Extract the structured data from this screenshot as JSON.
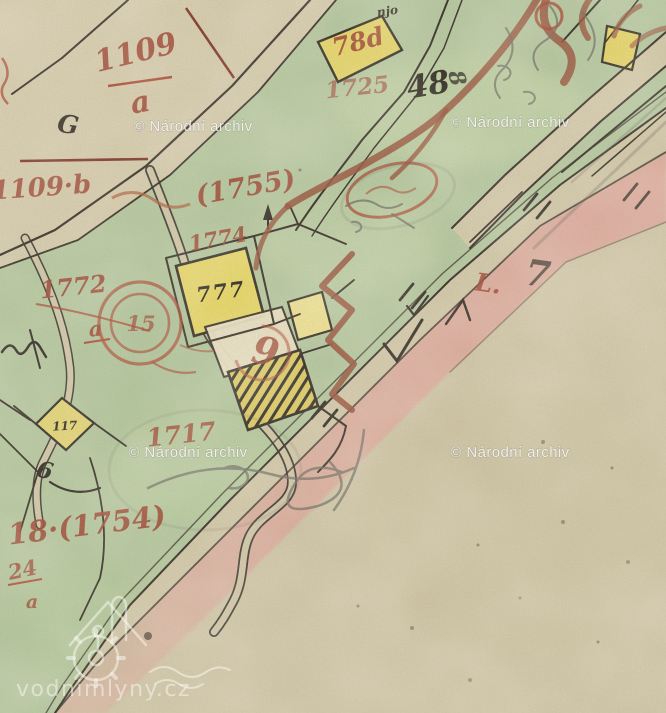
{
  "watermarks": {
    "archive": "© Národní archiv",
    "site": "vodnimlyny.cz"
  },
  "labels_red": {
    "frac1109_num": "1109",
    "frac1109_den": "a",
    "p1109b": "1109·b",
    "p1755": "(1755)",
    "p1725": "1725",
    "p78d": "78d",
    "p1774": "1774",
    "p1772": "1772",
    "a_mid": "a",
    "c15": "15",
    "p9": "9",
    "p1717": "1717",
    "p18_1754": "18·(1754)",
    "p24": "24",
    "p24a": "a",
    "mark_L": "L."
  },
  "labels_black": {
    "p48": "48",
    "p777": "777",
    "p117": "117",
    "gG": "G",
    "g6": "6",
    "njo": "njo",
    "g8": "8",
    "g7": "7"
  },
  "colors": {
    "parchment": "#cfc5a7",
    "field_green": "#b3c69e",
    "plot_yellow": "#e4d365",
    "road_pink": "#dca79b",
    "ink_red": "#9c4330",
    "ink_brown": "#96503a",
    "ink_black": "#2e2820",
    "pencil_grey": "#6e6b60",
    "watermark_white": "#fcfcfa"
  }
}
